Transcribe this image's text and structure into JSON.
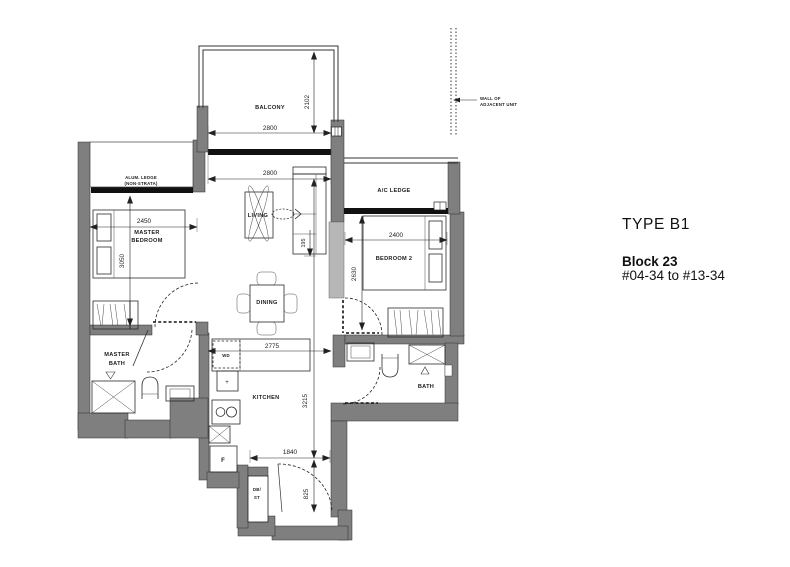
{
  "colors": {
    "wall": "#7f7f7f",
    "wall_light": "#b7b7b7",
    "line": "#1c1c1c",
    "background": "#ffffff"
  },
  "title_block": {
    "type_label": "TYPE B1",
    "block_label": "Block 23",
    "unit_range": "#04-34 to #13-34"
  },
  "notes": {
    "adjacent_wall_l1": "WALL OF",
    "adjacent_wall_l2": "ADJACENT UNIT",
    "alum_ledge_l1": "ALUM. LEDGE",
    "alum_ledge_l2": "(NON-STRATA)"
  },
  "rooms": {
    "balcony": "BALCONY",
    "living": "LIVING",
    "dining": "DINING",
    "kitchen": "KITCHEN",
    "master_bedroom_l1": "MASTER",
    "master_bedroom_l2": "BEDROOM",
    "bedroom2": "BEDROOM 2",
    "master_bath_l1": "MASTER",
    "master_bath_l2": "BATH",
    "bath": "BATH",
    "ac_ledge": "A/C LEDGE",
    "wd": "WD",
    "db_st_l1": "DB/",
    "db_st_l2": "ST",
    "fridge": "F",
    "sink_marker": "+"
  },
  "dimensions_mm": {
    "balcony_width": "2800",
    "balcony_depth": "2102",
    "living_width": "2800",
    "master_bedroom_width": "2450",
    "master_bedroom_length": "3050",
    "bedroom2_width": "2400",
    "bedroom2_length": "2630",
    "kitchen_dining_width": "2775",
    "kitchen_length": "3215",
    "entry_width": "1840",
    "entry_recess": "825",
    "sofa_ledge_depth": "195"
  }
}
